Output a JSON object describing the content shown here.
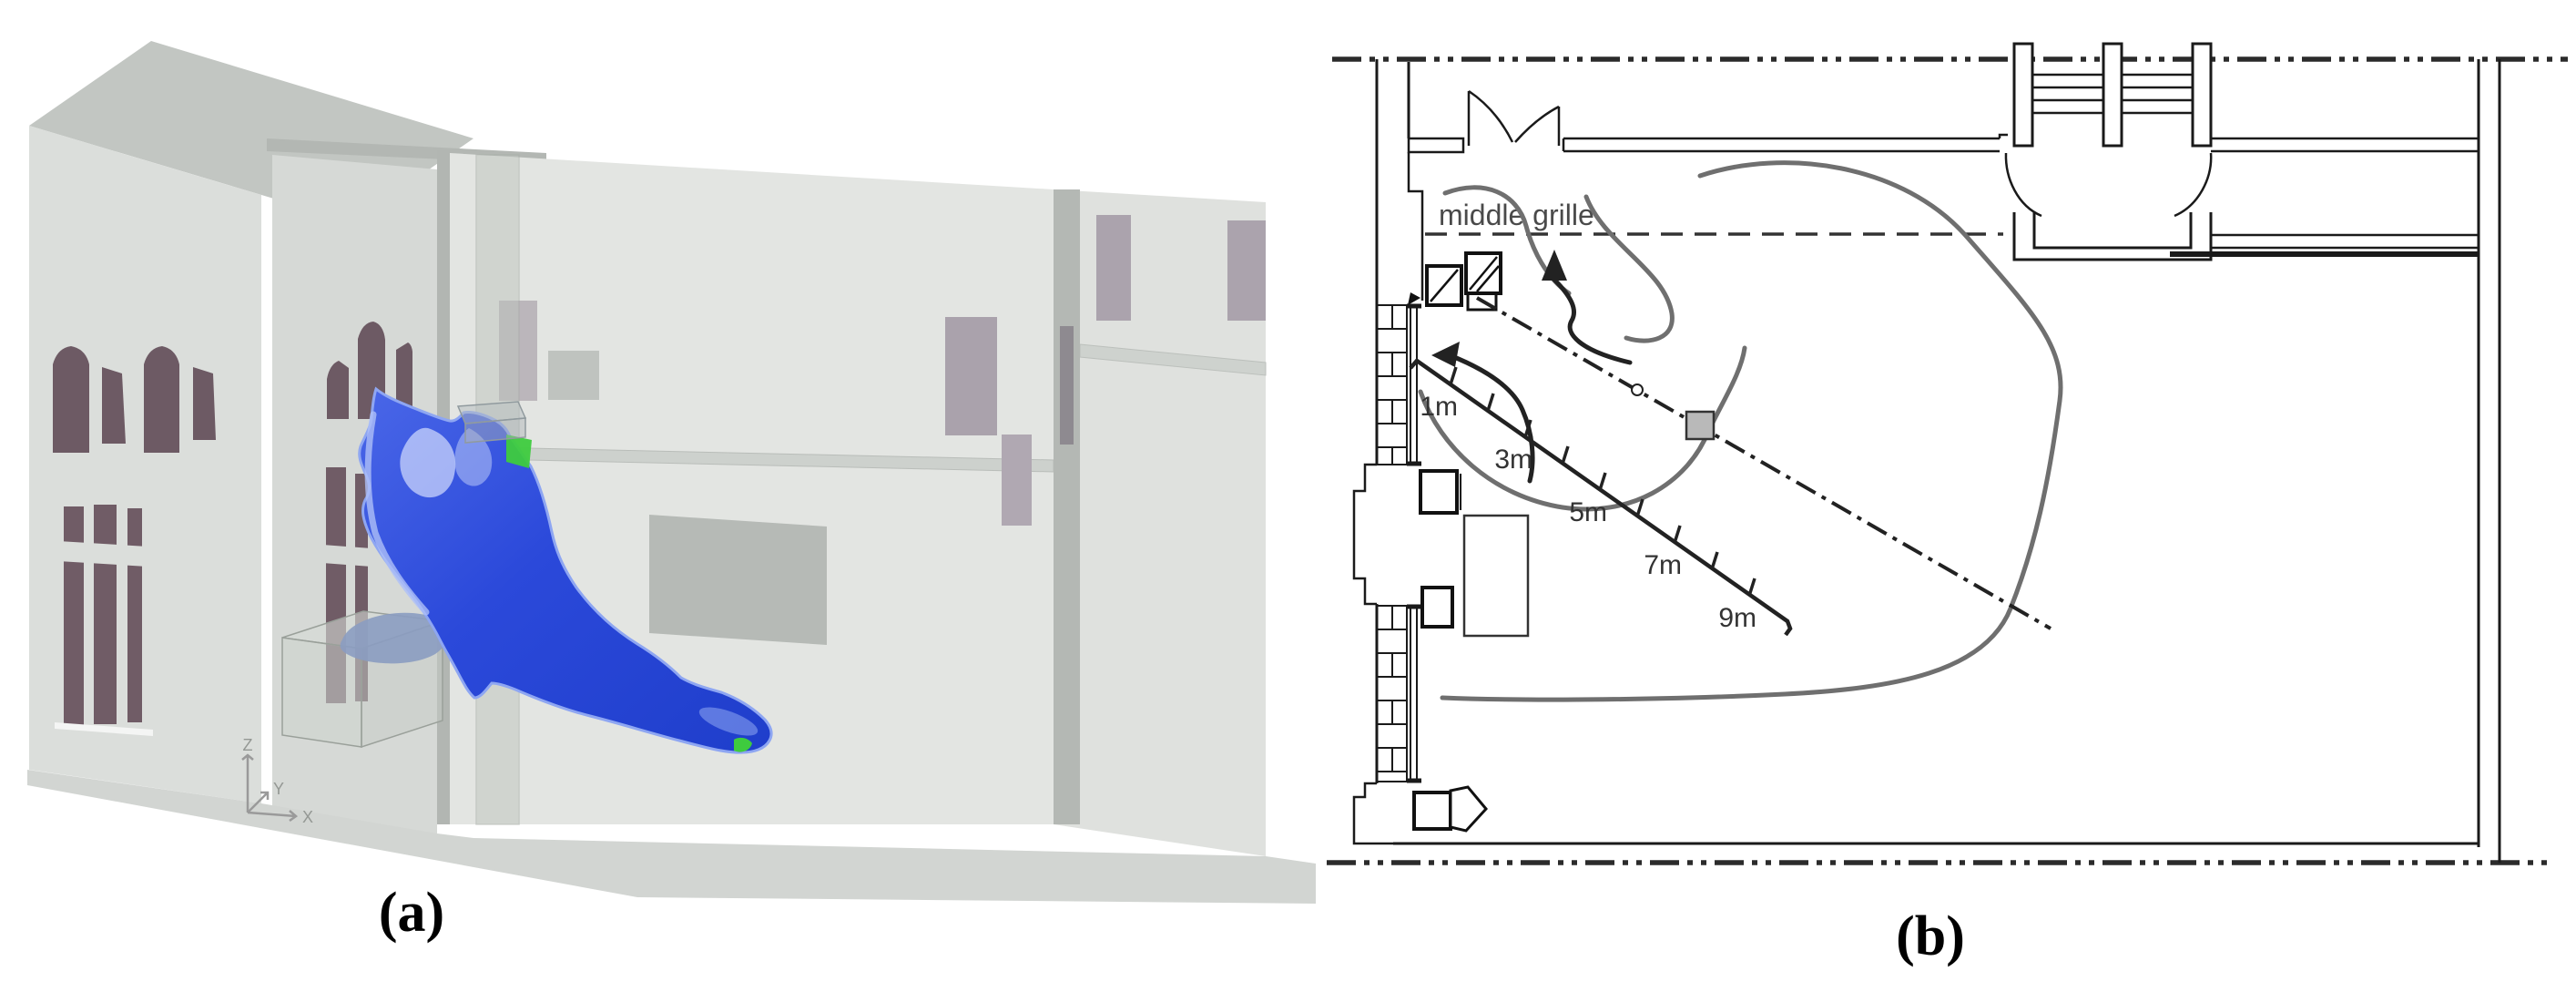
{
  "figure": {
    "panel_a": {
      "label": "(a)",
      "description": "3D CFD isosurface of cold air plume inside hall model",
      "axis": {
        "z": "Z",
        "y": "Y",
        "x": "X"
      }
    },
    "panel_b": {
      "label": "(b)",
      "description": "floor plan with airflow pattern and measurement transect",
      "grille_label": "middle grille",
      "distance_labels": [
        "1m",
        "3m",
        "5m",
        "7m",
        "9m"
      ]
    },
    "icons": {
      "axis_triad": "xyz-axis-triad",
      "source_marker": "grey-square",
      "flow_arrows": "curved-flow-arrows",
      "door_swing": "door-swing-arcs",
      "hatched_equipment": "hatched-boxes"
    },
    "colors": {
      "plume_blue": "#2b49da",
      "plume_light": "#9db2f6",
      "plume_highlight": "#dfe7ff",
      "plume_green": "#3ecb3e",
      "wall_grey": "#dcdfdc",
      "roof_grey": "#c2c6c2",
      "floor_grey": "#d2d5d2",
      "window_maroon": "#6d5a64",
      "interior_window_mauve": "#aaa2ac",
      "flow_grey": "#6f6f6f",
      "marker_grey": "#b9b9b9",
      "line_dark": "#222222"
    }
  }
}
